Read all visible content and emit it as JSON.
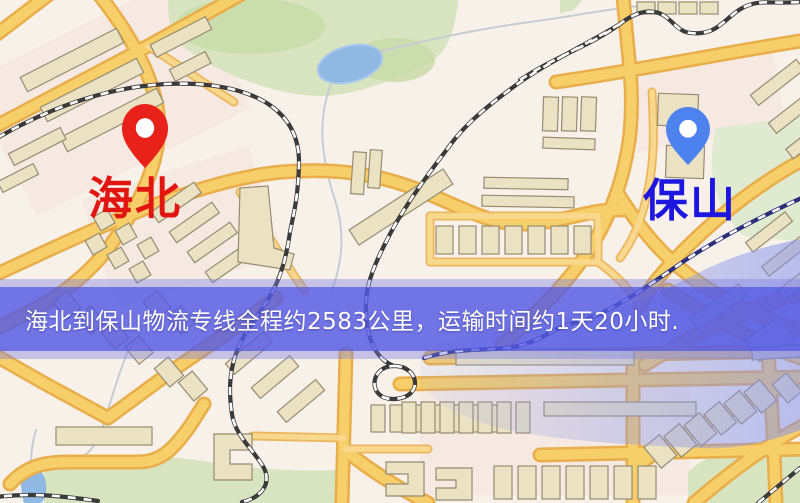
{
  "banner": {
    "text": "海北到保山物流专线全程约2583公里，运输时间约1天20小时.",
    "background_color": "#4d52e4",
    "text_color": "#ffffff"
  },
  "markers": {
    "origin": {
      "label": "海北",
      "pin_color": "#e8211a",
      "label_color": "#e21511"
    },
    "destination": {
      "label": "保山",
      "pin_color": "#4d82ef",
      "label_color": "#1c16e0"
    }
  },
  "map_colors": {
    "background": "#f7f1e9",
    "road_core": "#f7cf6a",
    "road_casing": "#e9ad4a",
    "park_green": "#d8e4c0",
    "water_blue": "#8fb9e3",
    "building_fill": "#ebe2c4",
    "railway_dark": "#3a3a3a"
  }
}
